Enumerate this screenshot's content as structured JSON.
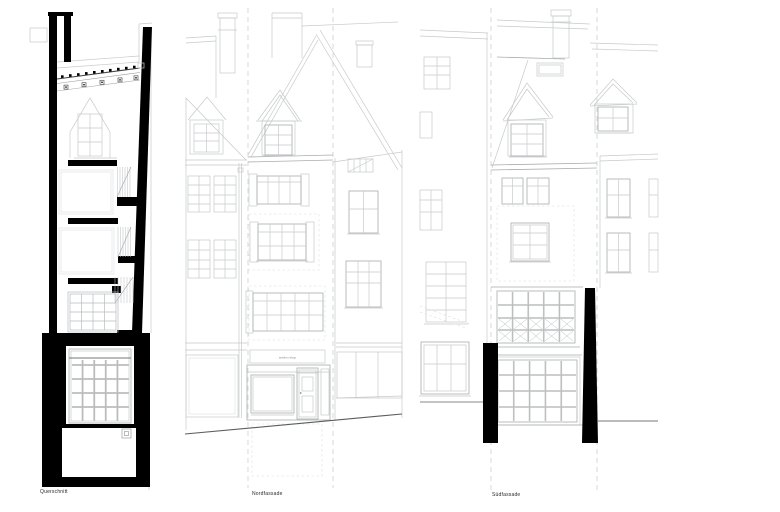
{
  "document": {
    "type": "architectural-drawing-sheet",
    "background": "#ffffff"
  },
  "drawings": [
    {
      "id": "querschnitt",
      "label": "Querschnitt"
    },
    {
      "id": "nordfassade",
      "label": "Nordfassade"
    },
    {
      "id": "suedfassade",
      "label": "Südfassade"
    }
  ],
  "labels": {
    "section": "Querschnitt",
    "north": "Nordfassade",
    "south": "Südfassade"
  },
  "shop_sign_text": "antiken-shop",
  "colors": {
    "ink": "#000000",
    "line_light": "#c6c9cb",
    "line_lighter": "#dcdedf",
    "line_mid": "#a9acae",
    "line_dark": "#6f7173",
    "street": "#5a5c5e",
    "background": "#ffffff"
  }
}
